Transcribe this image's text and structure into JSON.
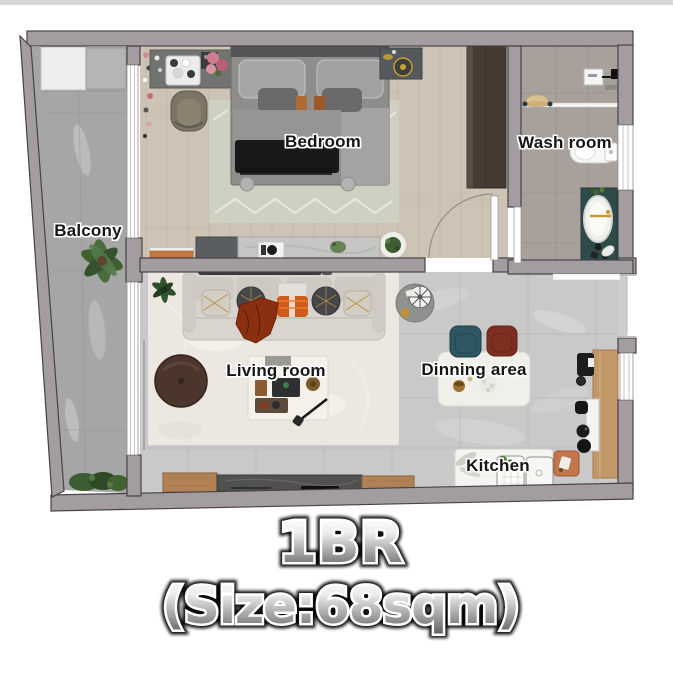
{
  "title": {
    "line1": "1BR",
    "line2": "(Size:68sqm)"
  },
  "rooms": {
    "bedroom": "Bedroom",
    "washroom": "Wash room",
    "balcony": "Balcony",
    "living_room": "Living room",
    "dining_area": "Dinning area",
    "kitchen": "Kitchen"
  },
  "palette": {
    "wall": "#a39da1",
    "wall_outline": "#474247",
    "wood_floor": "#cec4b6",
    "washroom_tile": "#a8a19b",
    "marble_floor": "#c9c9c9",
    "balcony_floor": "#a6a6a6",
    "living_rug": "#ece8e1",
    "bedroom_rug": "#ced0c2",
    "accent_orange": "#d2601e",
    "chair_teal": "#2e5663",
    "chair_red": "#7e2f20",
    "tub_panel_teal": "#2f4b49",
    "counter_wood": "#c39868"
  }
}
